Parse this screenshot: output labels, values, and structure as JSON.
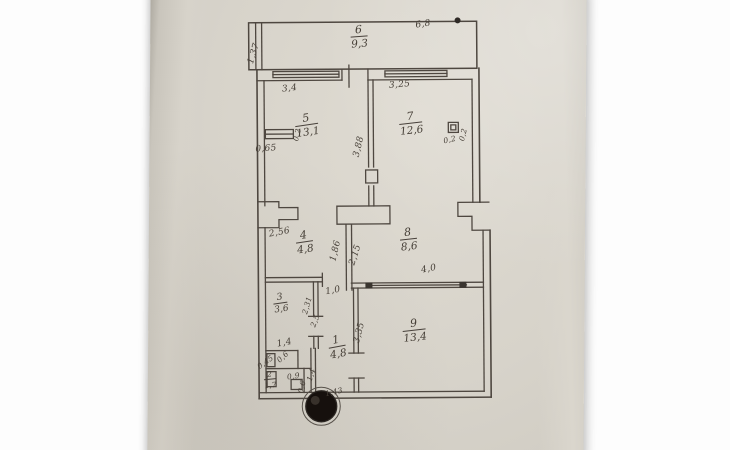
{
  "plan": {
    "rooms": [
      {
        "number": "6",
        "area": "9,3"
      },
      {
        "number": "5",
        "area": "13,1"
      },
      {
        "number": "7",
        "area": "12,6"
      },
      {
        "number": "4",
        "area": "4,8"
      },
      {
        "number": "8",
        "area": "8,6"
      },
      {
        "number": "3",
        "area": "3,6"
      },
      {
        "number": "1",
        "area": "4,8"
      },
      {
        "number": "9",
        "area": "13,4"
      },
      {
        "number": "2",
        "area": "1,7"
      }
    ],
    "dimensions": [
      {
        "text": "1,37"
      },
      {
        "text": "6,8"
      },
      {
        "text": "3,4"
      },
      {
        "text": "3,25"
      },
      {
        "text": "0,65"
      },
      {
        "text": "0,2"
      },
      {
        "text": "3,88"
      },
      {
        "text": "0,2"
      },
      {
        "text": "0,2"
      },
      {
        "text": "2,56"
      },
      {
        "text": "1,86"
      },
      {
        "text": "2,15"
      },
      {
        "text": "4,0"
      },
      {
        "text": "1,0"
      },
      {
        "text": "2,31"
      },
      {
        "text": "2,5"
      },
      {
        "text": "1,4"
      },
      {
        "text": "0,45"
      },
      {
        "text": "0,6"
      },
      {
        "text": "0,9"
      },
      {
        "text": "0,6"
      },
      {
        "text": "1,4"
      },
      {
        "text": "3,35"
      },
      {
        "text": "1,43"
      }
    ]
  }
}
